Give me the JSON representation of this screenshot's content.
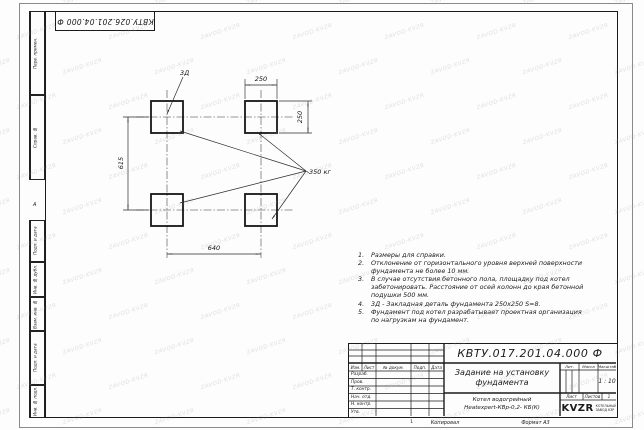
{
  "sheet": {
    "watermark": "ZAVOD-KVZR",
    "top_stamp": "КВТУ.026.201.04.000 Ф",
    "zone_marker": "А",
    "sheet_tick": "1",
    "copied_label": "Копировал",
    "format_label": "Формат А3"
  },
  "margin_boxes": [
    {
      "label": "Перв. примен."
    },
    {
      "label": "Справ. №"
    },
    {
      "label": "Подп. и дата"
    },
    {
      "label": "Инв. № дубл."
    },
    {
      "label": "Взам. инв. №"
    },
    {
      "label": "Подп. и дата"
    },
    {
      "label": "Инв. № подл."
    }
  ],
  "drawing": {
    "dims": {
      "top": "250",
      "right": "250",
      "left": "615",
      "bottom": "640"
    },
    "embed_label": "3Д",
    "weight_label": "350 кг"
  },
  "notes": [
    {
      "num": "1.",
      "text": "Размеры для справки."
    },
    {
      "num": "2.",
      "text": "Отклонение от горизонтального уровня верхней поверхности фундамента не более 10 мм."
    },
    {
      "num": "3.",
      "text": "В случае отсутствия бетонного пола, площадку под котел забетонировать. Расстояние от осей колонн до края бетонной подушки 500 мм."
    },
    {
      "num": "4.",
      "text": "3Д - Закладная деталь фундамента 250х250 S=8."
    },
    {
      "num": "5.",
      "text": "Фундамент под котел разрабатывает проектная организация по нагрузкам на фундамент."
    }
  ],
  "title_block": {
    "doc_number": "КВТУ.017.201.04.000 Ф",
    "title": "Задание на установку фундамента",
    "product_line1": "Котел водогрейный",
    "product_line2": "Heatexpert-КВр-0,2- КБ(К)",
    "header_cols": [
      "Изм.",
      "Лист",
      "№ докум.",
      "Подп.",
      "Дата"
    ],
    "sign_rows": [
      "Разраб.",
      "Пров.",
      "Т. контр.",
      "Нач. отд.",
      "Н. контр.",
      "Утв."
    ],
    "lit_label": "Лит.",
    "mass_label": "Масса",
    "scale_label": "Масштаб",
    "scale_value": "1 : 10",
    "sheet_label": "Лист",
    "sheets_label": "Листов",
    "sheets_value": "1",
    "logo_text": "KVZR",
    "company_line1": "КОТЕЛЬНЫЙ",
    "company_line2": "ЗАВОД КЗР"
  }
}
